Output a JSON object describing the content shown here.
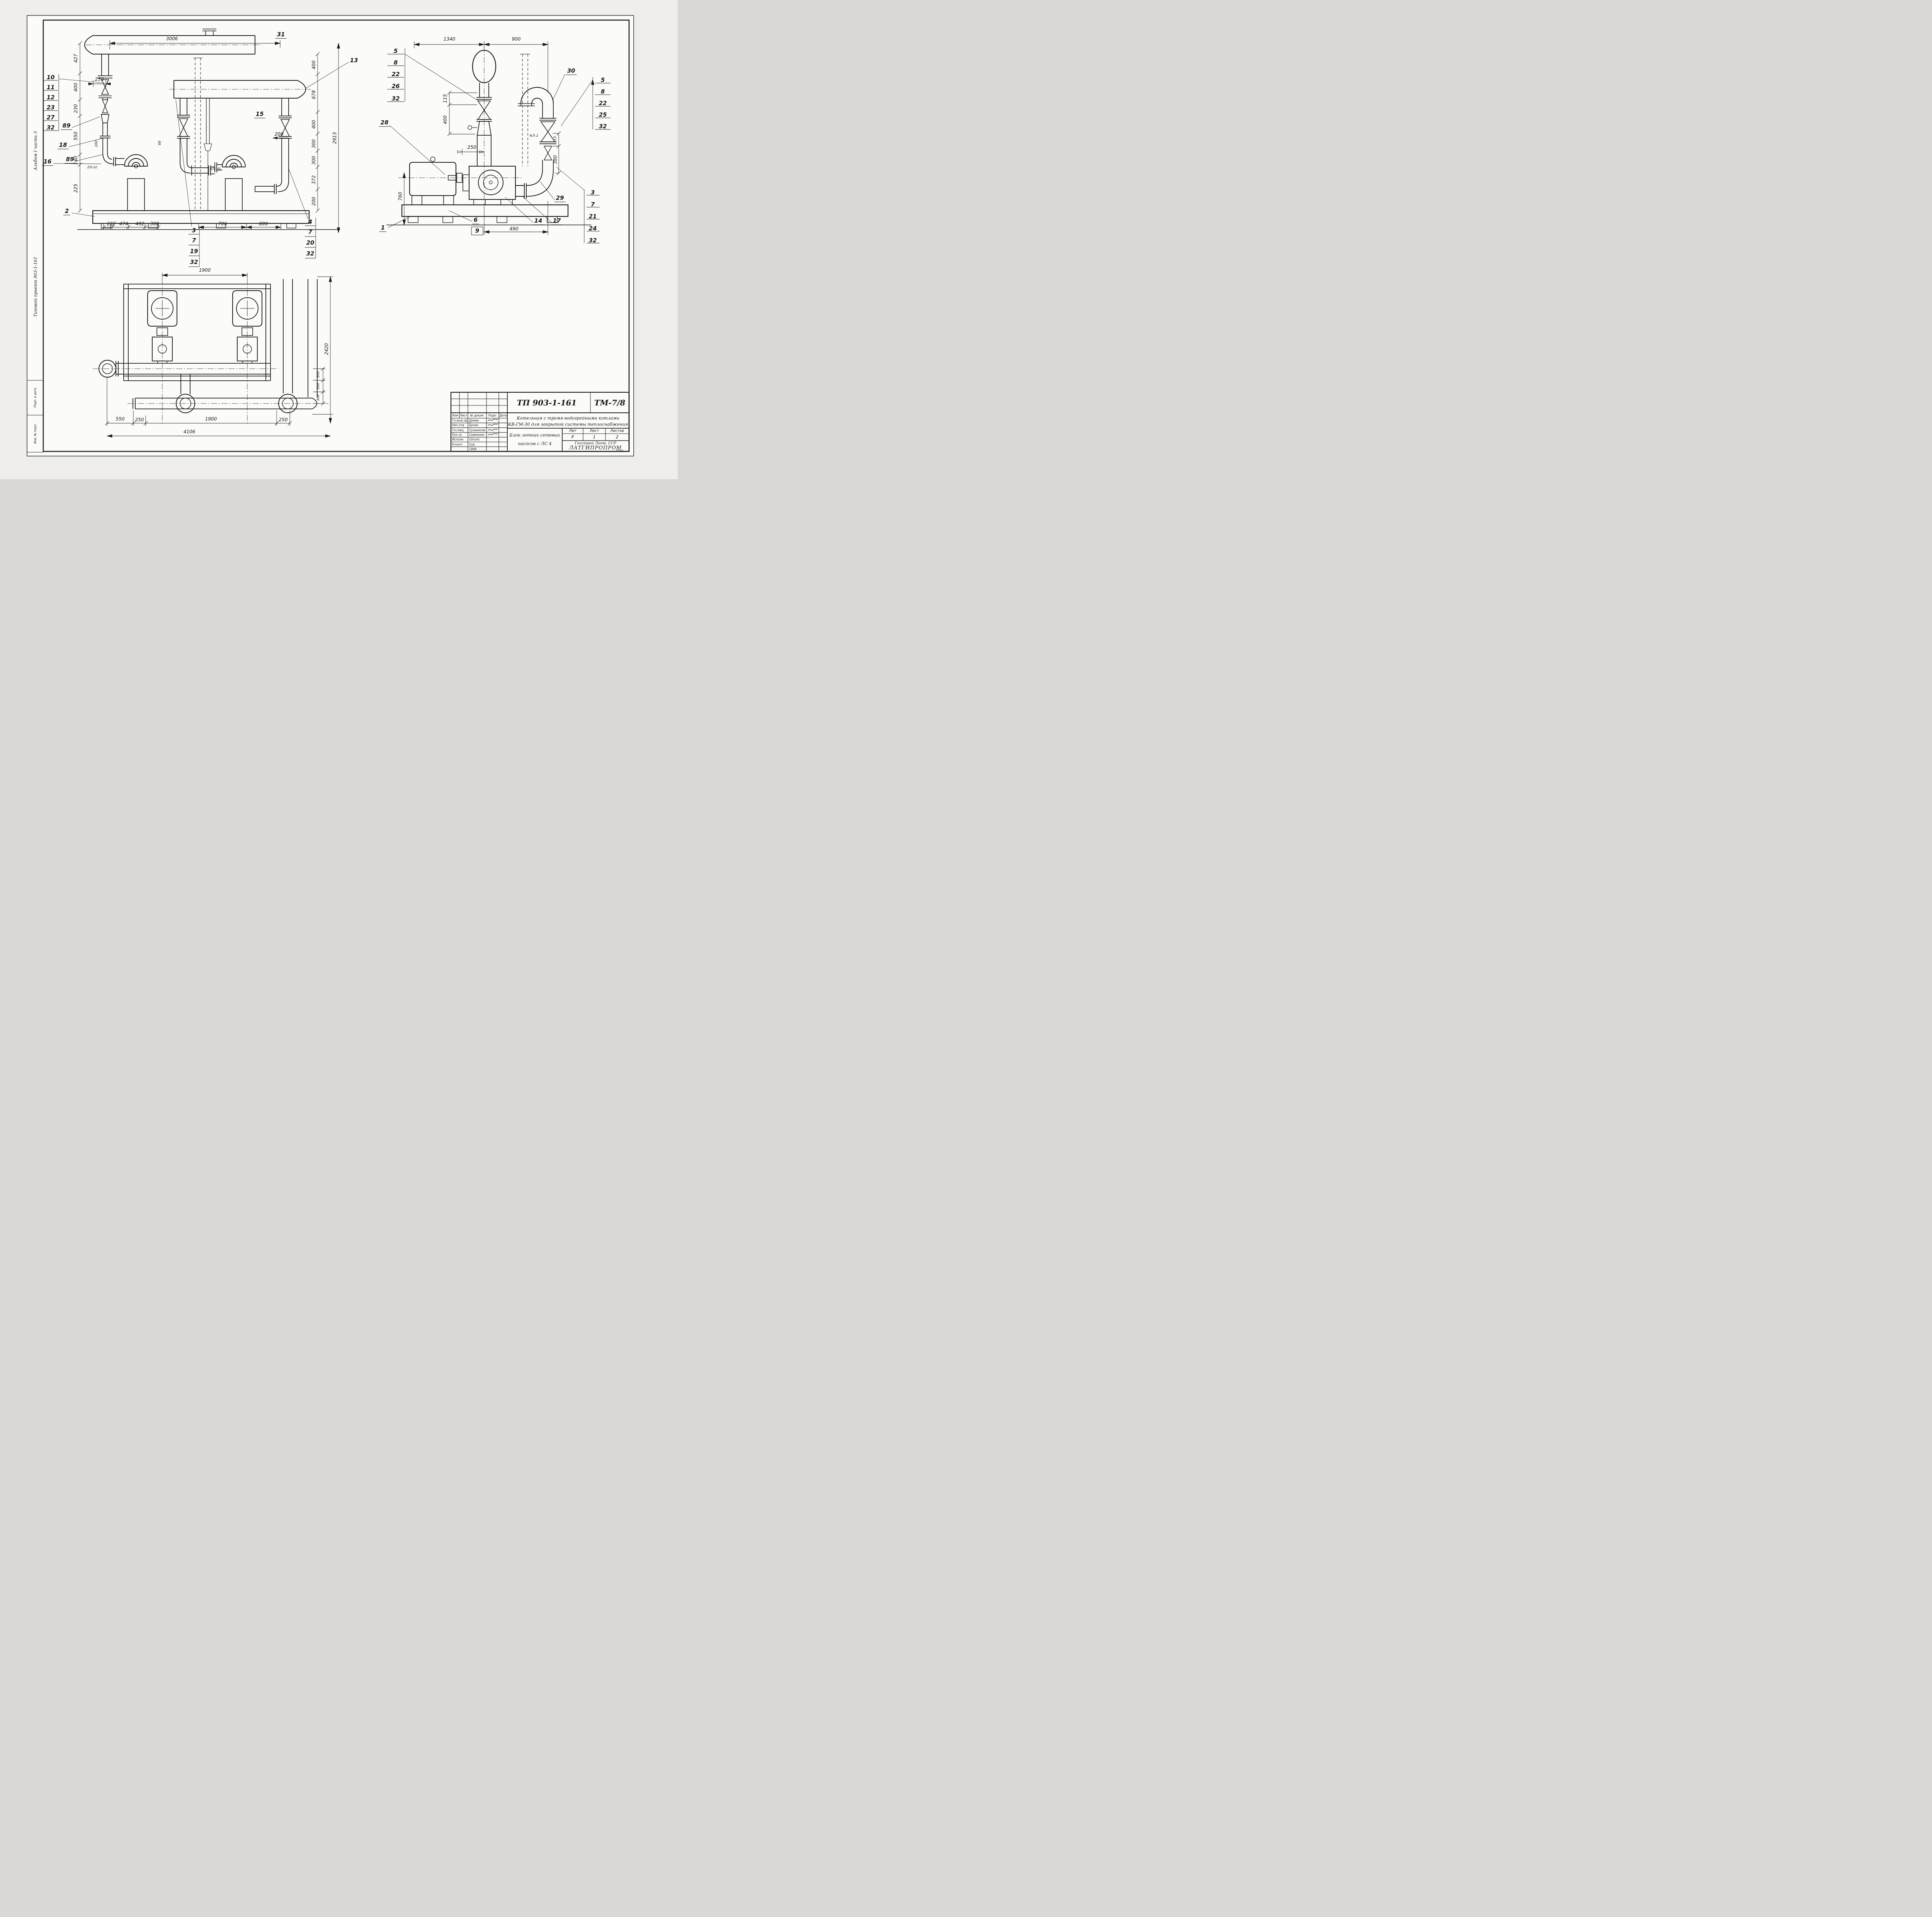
{
  "sheet": {
    "code_tp": "ТП 903-1-161",
    "code_tm": "ТМ-7/8"
  },
  "margin": {
    "album": "Альбом I часть 3",
    "project": "Типовой проект 903-1-161",
    "stamp_top": "Подп. и дата",
    "stamp_bottom": "Инв. № подл."
  },
  "front": {
    "dim_3006": "3006",
    "dim_250": "250",
    "mark_31": "31",
    "callout_13": "13",
    "callout_15": "15",
    "stack_left": [
      "10",
      "11",
      "12",
      "23",
      "27",
      "32"
    ],
    "callout_89a": "89",
    "callout_18": "18",
    "callout_16": "16",
    "callout_89b": "89",
    "callout_2": "2",
    "left_chain": [
      "427",
      "400",
      "230",
      "550",
      "140",
      "225"
    ],
    "right_chain": [
      "400",
      "678",
      "400",
      "300",
      "300",
      "372",
      "200"
    ],
    "dim_total": "2913",
    "dim_200": "200",
    "dim_260": "260",
    "dim_68": "68",
    "tag_ll6": "ЛЛ-VI",
    "tag_kl7": "КЛ-VII",
    "bottom_dims": [
      "232",
      "474",
      "492",
      "308"
    ],
    "callout_3": "3",
    "stack_3": [
      "7",
      "19",
      "32"
    ],
    "dim_706": "706",
    "dim_800": "800",
    "callout_4": "4",
    "stack_4": [
      "7",
      "20",
      "32"
    ]
  },
  "side": {
    "dim_1340": "1340",
    "dim_900": "900",
    "stack_left": [
      "5",
      "8",
      "22",
      "26",
      "32"
    ],
    "callout_28": "28",
    "callout_30": "30",
    "stack_right": [
      "5",
      "8",
      "22",
      "25",
      "32"
    ],
    "dim_115a": "115",
    "dim_400": "400",
    "dim_250": "250",
    "dim_760": "760",
    "tag_kl1": "КЛ-1",
    "dim_115b": "115",
    "dim_380": "380",
    "dim_490": "490",
    "callout_1": "1",
    "callout_6": "6",
    "callout_9": "9",
    "callout_14": "14",
    "callout_17": "17",
    "callout_29": "29",
    "stack_lower_right": [
      "3",
      "7",
      "21",
      "24",
      "32"
    ]
  },
  "plan": {
    "dim_1900_top": "1900",
    "dim_2420": "2420",
    "chain_300": [
      "300",
      "300",
      "300"
    ],
    "bottom_dims": [
      "550",
      "250",
      "1900",
      "250"
    ],
    "dim_4106": "4106"
  },
  "title_block": {
    "doc_title_line1": "Котельная с тремя водогрейными котлами",
    "doc_title_line2": "КВ-ГМ-30 для закрытой системы теплоснабжения",
    "subject_line1": "Блок летних сетевых",
    "subject_line2": "насосов с ЛС 4",
    "org_line1": "Госстрой Латв. ССР",
    "org_line2": "ЛАТГИПРОПРОМ",
    "org_city": "Рига",
    "lit_headers": [
      "Лит",
      "Лист",
      "Листов"
    ],
    "lit_values": [
      "Р",
      "1",
      "2"
    ],
    "cols": [
      "Изм",
      "Лист",
      "№ докум.",
      "Подп.",
      "Дата"
    ],
    "staff": [
      {
        "role": "Гл.инж.пр.",
        "name": "Думан"
      },
      {
        "role": "Нач.отд",
        "name": "Букин"
      },
      {
        "role": "Гл.спец",
        "name": "Суханосов"
      },
      {
        "role": "Рук.гр.",
        "name": "Сурмонин"
      },
      {
        "role": "Исполн.",
        "name": "Сетупс"
      },
      {
        "role": "Н.конт.",
        "name": "Сур."
      },
      {
        "role": "",
        "name": "1968"
      }
    ]
  }
}
